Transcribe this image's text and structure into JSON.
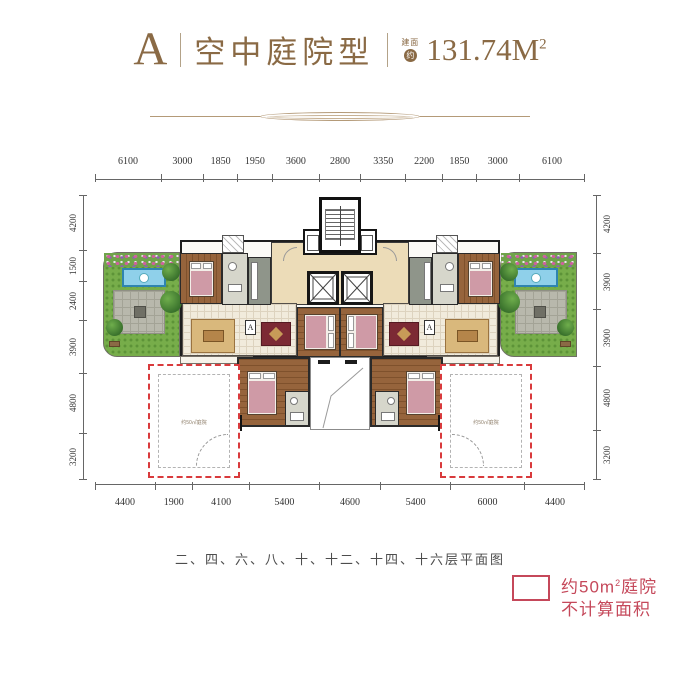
{
  "header": {
    "type_letter": "A",
    "type_name": "空中庭院型",
    "area_prefix_top": "建面",
    "area_prefix_badge": "约",
    "area_value": "131.74M",
    "area_sup": "2"
  },
  "dimensions": {
    "top": [
      "6100",
      "3000",
      "1850",
      "1950",
      "3600",
      "2800",
      "3350",
      "2200",
      "1850",
      "3000",
      "6100"
    ],
    "bottom": [
      "4400",
      "1900",
      "4100",
      "5400",
      "4600",
      "5400",
      "6000",
      "4400"
    ],
    "left": [
      "4200",
      "1500",
      "2400",
      "3900",
      "4800",
      "3200"
    ],
    "right": [
      "4200",
      "3900",
      "3900",
      "4800",
      "3200"
    ]
  },
  "plan": {
    "section_marker": "A",
    "courtyard_label": "约50㎡庭院"
  },
  "caption": "二、四、六、八、十、十二、十四、十六层平面图",
  "legend": {
    "line1_pre": "约50m",
    "line1_sup": "2",
    "line1_post": "庭院",
    "line2": "不计算面积"
  },
  "colors": {
    "title_brown": "#8a6a45",
    "legend_red": "#c5485a",
    "courtyard_red": "#d93a3c",
    "lawn_green": "#77ad4a",
    "pool_blue": "#8fd0ea",
    "wood_brown": "#96643c",
    "tile_cream": "#f1ebdc",
    "lobby_cream": "#ecdcb8"
  }
}
